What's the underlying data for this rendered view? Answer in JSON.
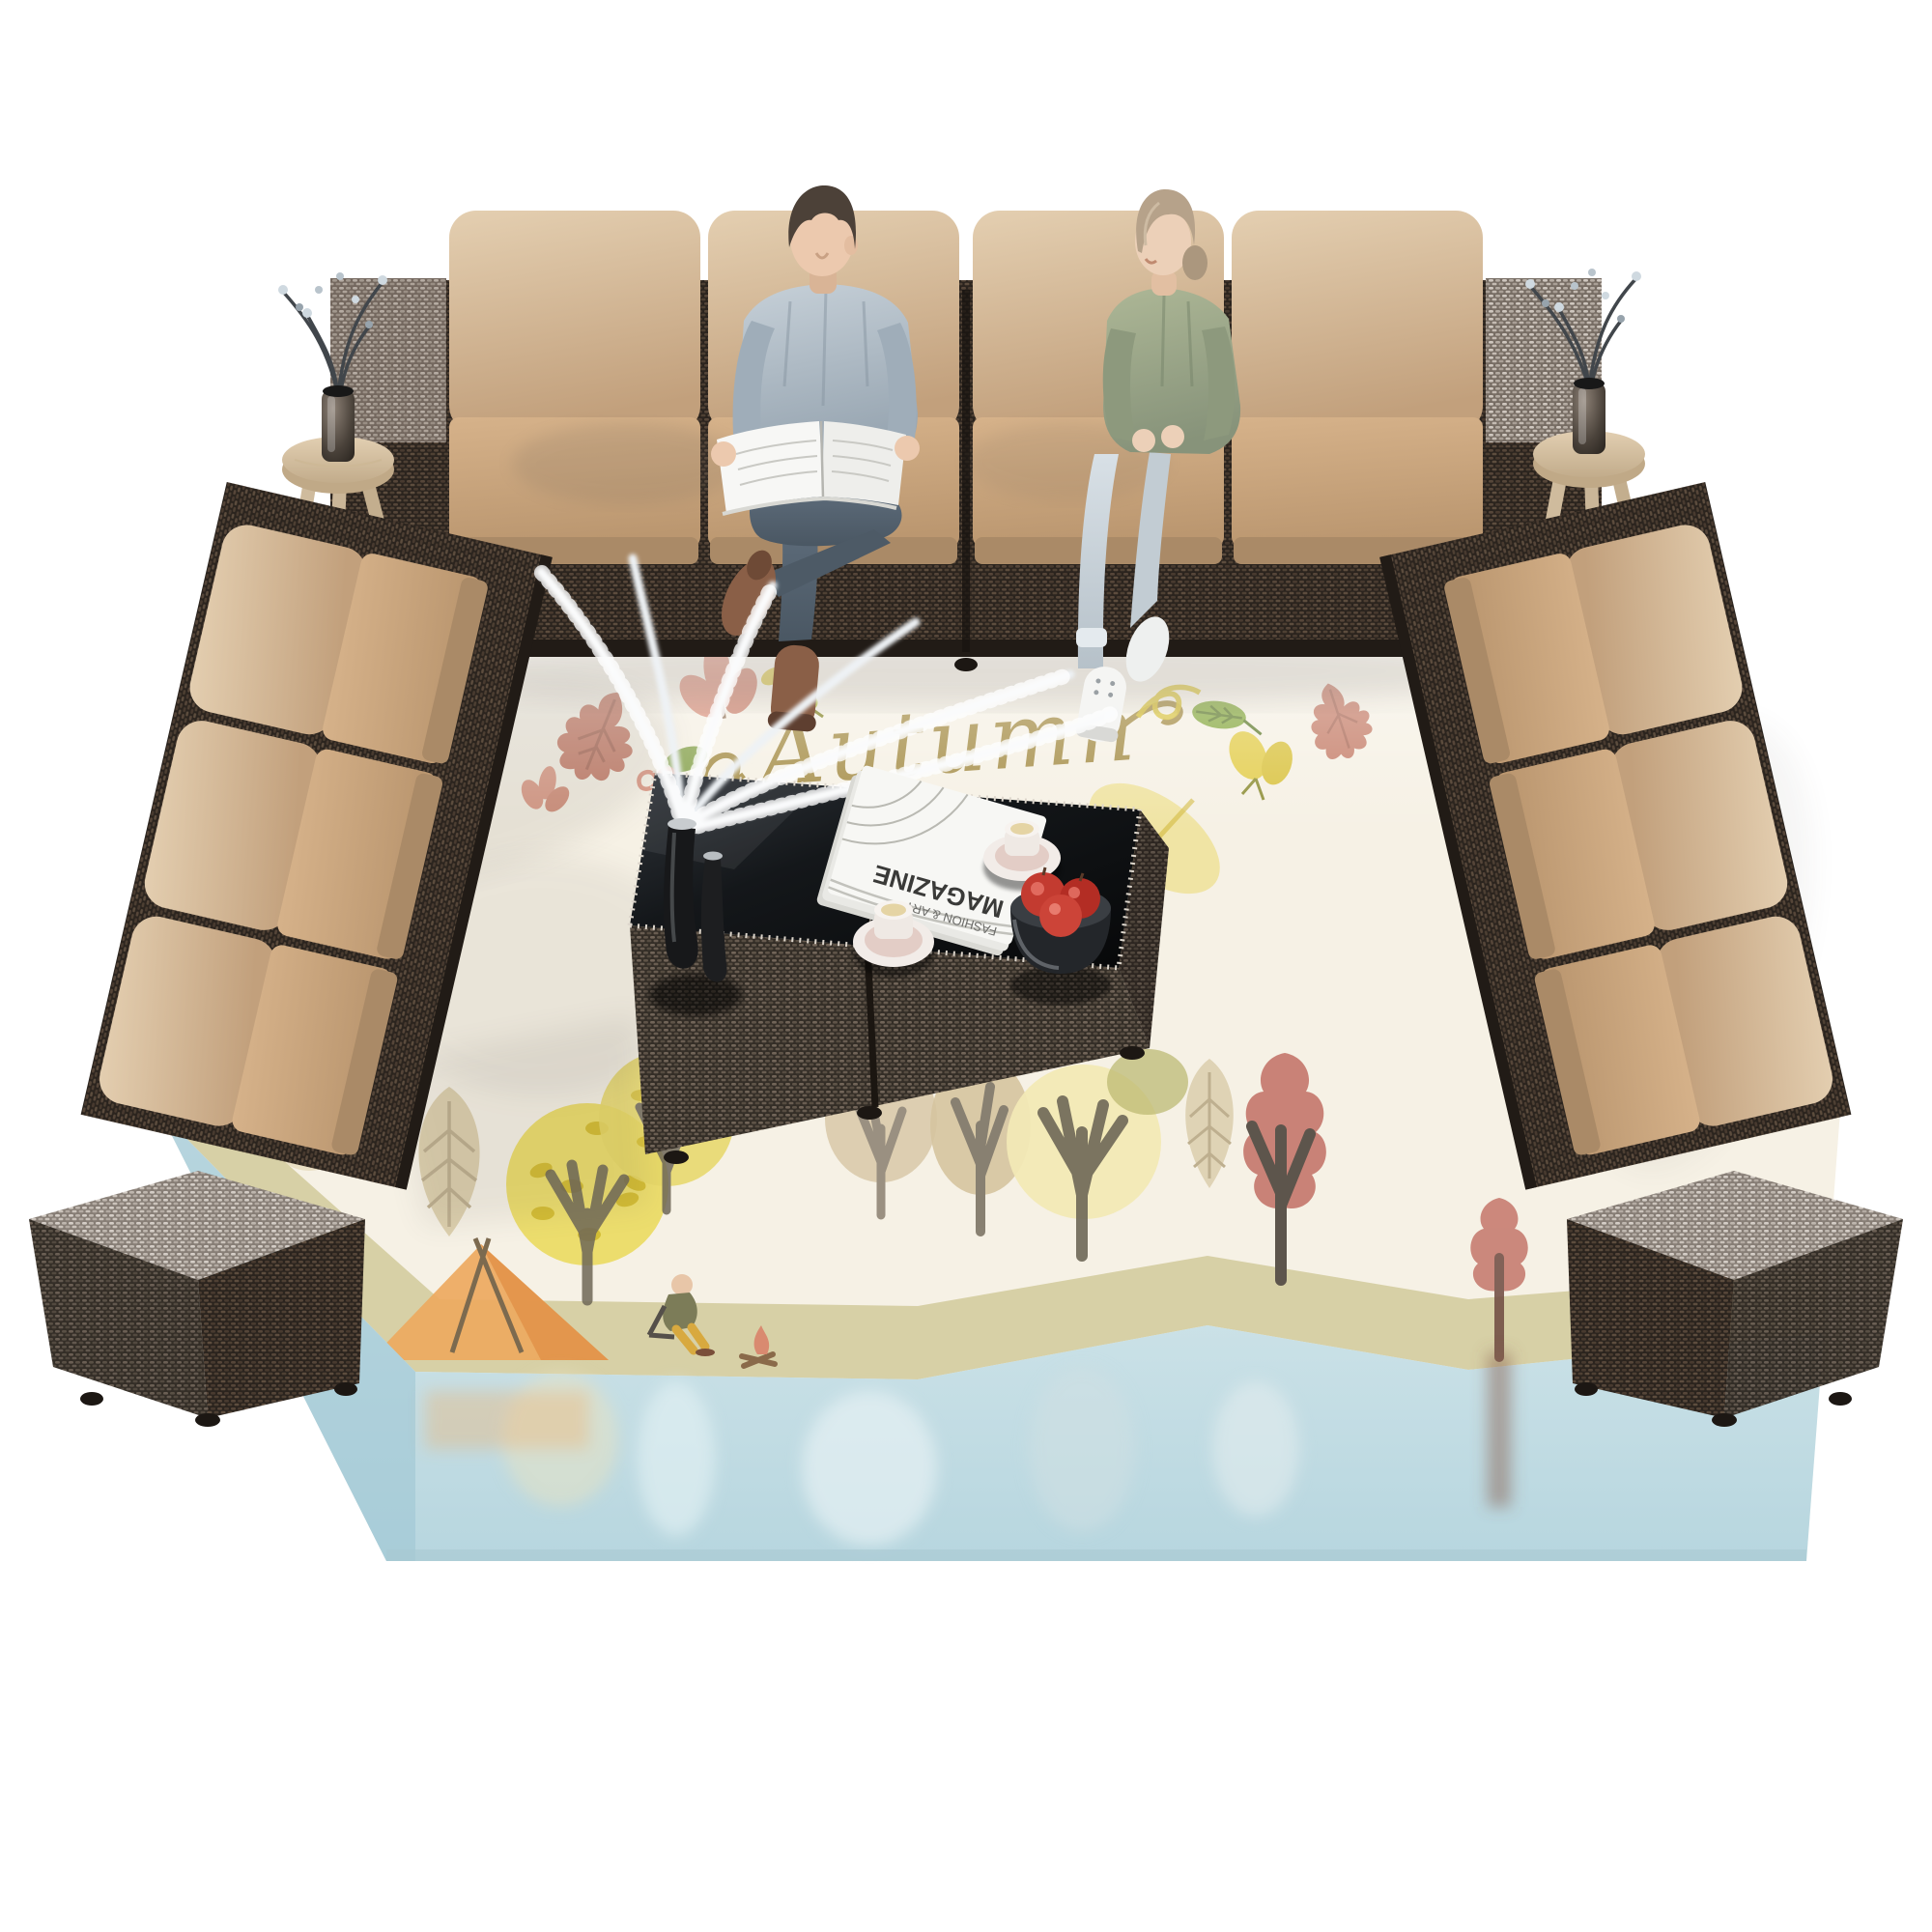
{
  "scene": {
    "title": "Outdoor rattan sectional patio set - top view product photo",
    "background_color": "#ffffff",
    "wicker_dark": "#4a3d32",
    "wicker_light": "#b9afa6",
    "cushion_tan": "#cba781"
  },
  "rug": {
    "script_text": "Autumn",
    "base_color": "#f6f1e5",
    "grass_color": "#d5cda2",
    "water_color": "#c3dce4",
    "motif_names": [
      "rust-oak-leaf",
      "coral-flower",
      "green-leaf",
      "yellow-leaf",
      "yellow-curl",
      "cursive-autumn-script",
      "orange-camping-tent",
      "camper-by-campfire",
      "stylized-autumn-trees",
      "lake-with-reflections"
    ]
  },
  "furniture": {
    "top_sofa_seats": 4,
    "side_sofa_seats": 3,
    "armrest_cubes": 4,
    "wood_stools": 2,
    "coffee_tables": 2
  },
  "tables": {
    "magazine_title": "MAGAZINE",
    "magazine_subtitle": "FASHION & ART",
    "top_color": "#101316",
    "items": [
      "black-vases-with-white-branches",
      "magazine-stack",
      "coffee-cup-left",
      "coffee-cup-right",
      "steel-bowl-of-red-apples"
    ]
  },
  "people": [
    {
      "id": "man",
      "pose": "reading-newspaper-legs-crossed",
      "top_color": "#aebbc6",
      "pants": "dark-jeans",
      "shoes": "brown"
    },
    {
      "id": "woman",
      "pose": "seated-hands-on-lap-looking-left",
      "top_color": "#9aa687",
      "pants": "light-jeans",
      "shoes": "white-sneakers"
    }
  ]
}
